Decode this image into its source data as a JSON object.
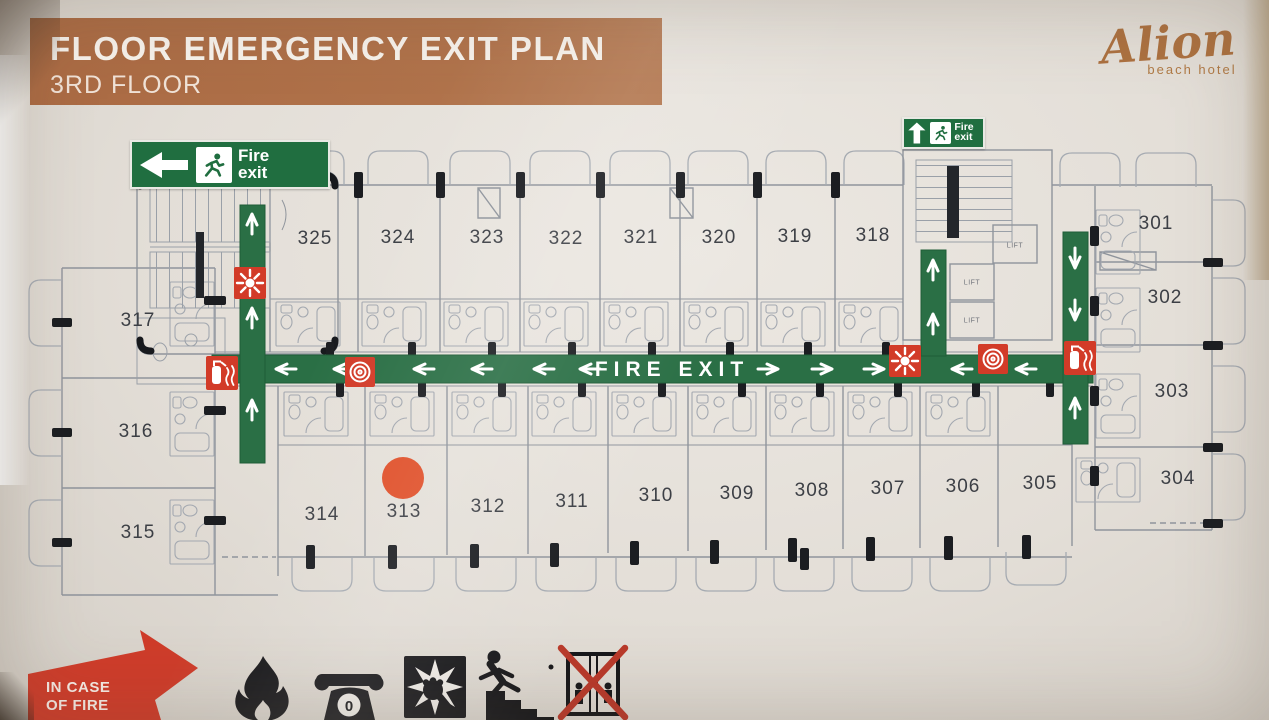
{
  "header": {
    "title": "FLOOR EMERGENCY EXIT PLAN",
    "subtitle": "3RD FLOOR"
  },
  "logo": {
    "name": "Alion",
    "tagline": "beach hotel"
  },
  "corridor": {
    "label": "FIRE EXIT"
  },
  "signs": {
    "left_exit": "Fire exit",
    "top_exit": "Fire exit"
  },
  "labels": {
    "lift": "LIFT"
  },
  "rooms": {
    "top": [
      "325",
      "324",
      "323",
      "322",
      "321",
      "320",
      "319",
      "318"
    ],
    "right": [
      "301",
      "302",
      "303",
      "304"
    ],
    "left": [
      "317",
      "316",
      "315"
    ],
    "bottom": [
      "314",
      "313",
      "312",
      "311",
      "310",
      "309",
      "308",
      "307",
      "306",
      "305"
    ]
  },
  "legend": {
    "banner_line1": "IN CASE",
    "banner_line2": "OF FIRE"
  },
  "colors": {
    "header_bar": "#ae6f48",
    "logo_brown": "#ac7140",
    "escape_green": "#2a6f45",
    "safety_red": "#d23b28",
    "marker_orange": "#e0502a"
  }
}
